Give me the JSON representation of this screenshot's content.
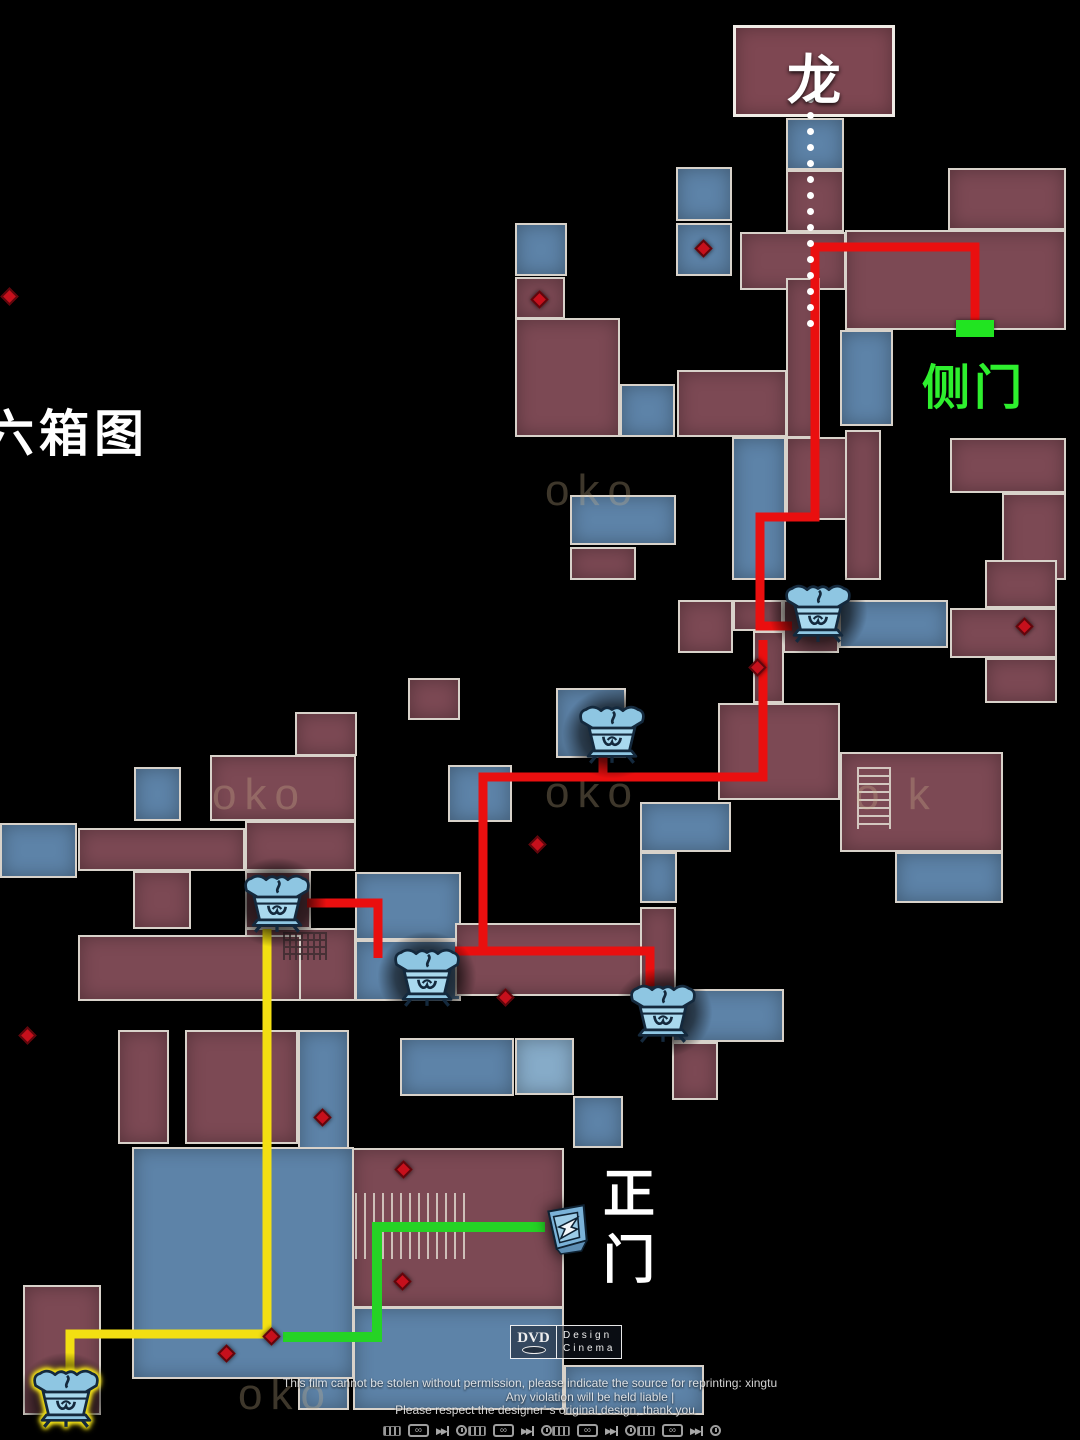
{
  "labels": {
    "dragon": "龙",
    "side_door": "侧门",
    "map_title": "六箱图",
    "main_gate": "正门"
  },
  "watermark": {
    "line1": "This film cannot be stolen without permission, please indicate the source for reprinting: xingtu",
    "line2": "Any violation will be held liable |",
    "line3": "Please respect the designer' s original design, thank you"
  },
  "brand": {
    "name": "DVD",
    "design": "Design",
    "cinema": "Cinema"
  },
  "colors": {
    "background": "#000000",
    "room_red": "#7c4954",
    "room_blue": "#5d83a8",
    "room_blue_light": "#86abc8",
    "wall": "#d8d2ca",
    "path_red": "#ea0f0f",
    "path_yellow": "#f3df12",
    "path_green": "#25d325",
    "door_marker_green": "#21e421",
    "label_green": "#2ef02e",
    "diamond_red": "#c6101c",
    "jar_blue": "#a9d9ee",
    "jar_outline": "#14293d",
    "highlight_yellow": "#f2e117"
  },
  "map": {
    "rooms": [
      [
        733,
        25,
        162,
        92,
        "mb"
      ],
      [
        786,
        118,
        58,
        52,
        "b"
      ],
      [
        786,
        170,
        58,
        62,
        "m"
      ],
      [
        676,
        167,
        56,
        54,
        "b"
      ],
      [
        676,
        223,
        56,
        53,
        "b"
      ],
      [
        740,
        232,
        106,
        58,
        "m"
      ],
      [
        948,
        168,
        118,
        62,
        "m"
      ],
      [
        845,
        230,
        221,
        100,
        "m"
      ],
      [
        515,
        223,
        52,
        53,
        "b"
      ],
      [
        515,
        277,
        50,
        42,
        "m"
      ],
      [
        515,
        318,
        105,
        119,
        "m"
      ],
      [
        620,
        384,
        55,
        53,
        "b"
      ],
      [
        677,
        370,
        110,
        67,
        "m"
      ],
      [
        786,
        278,
        34,
        160,
        "m"
      ],
      [
        732,
        437,
        54,
        143,
        "b"
      ],
      [
        786,
        437,
        64,
        83,
        "m"
      ],
      [
        570,
        495,
        106,
        50,
        "b"
      ],
      [
        570,
        547,
        66,
        33,
        "m"
      ],
      [
        840,
        330,
        53,
        96,
        "b"
      ],
      [
        845,
        430,
        36,
        150,
        "m"
      ],
      [
        950,
        438,
        116,
        55,
        "m"
      ],
      [
        1002,
        493,
        64,
        87,
        "m"
      ],
      [
        985,
        560,
        72,
        48,
        "m"
      ],
      [
        950,
        608,
        107,
        50,
        "m"
      ],
      [
        985,
        658,
        72,
        45,
        "m"
      ],
      [
        678,
        600,
        55,
        53,
        "m"
      ],
      [
        733,
        600,
        50,
        31,
        "m"
      ],
      [
        783,
        600,
        56,
        53,
        "m"
      ],
      [
        839,
        600,
        109,
        48,
        "b"
      ],
      [
        753,
        631,
        31,
        72,
        "m"
      ],
      [
        718,
        703,
        122,
        97,
        "m"
      ],
      [
        840,
        752,
        163,
        100,
        "m"
      ],
      [
        895,
        852,
        108,
        51,
        "b"
      ],
      [
        640,
        802,
        91,
        50,
        "b"
      ],
      [
        556,
        688,
        70,
        70,
        "b"
      ],
      [
        640,
        852,
        37,
        51,
        "b"
      ],
      [
        408,
        678,
        52,
        42,
        "m"
      ],
      [
        448,
        765,
        64,
        57,
        "b"
      ],
      [
        210,
        755,
        146,
        66,
        "m"
      ],
      [
        295,
        712,
        62,
        44,
        "m"
      ],
      [
        78,
        828,
        167,
        43,
        "m"
      ],
      [
        133,
        871,
        58,
        58,
        "m"
      ],
      [
        245,
        821,
        111,
        50,
        "m"
      ],
      [
        245,
        871,
        66,
        58,
        "m"
      ],
      [
        134,
        767,
        47,
        54,
        "b"
      ],
      [
        0,
        823,
        77,
        55,
        "b"
      ],
      [
        355,
        872,
        106,
        68,
        "b"
      ],
      [
        245,
        928,
        111,
        73,
        "m"
      ],
      [
        78,
        935,
        223,
        66,
        "m"
      ],
      [
        355,
        940,
        106,
        61,
        "b"
      ],
      [
        455,
        923,
        196,
        73,
        "m"
      ],
      [
        640,
        907,
        36,
        97,
        "m"
      ],
      [
        672,
        989,
        112,
        53,
        "b"
      ],
      [
        672,
        1042,
        46,
        58,
        "m"
      ],
      [
        118,
        1030,
        51,
        114,
        "m"
      ],
      [
        185,
        1030,
        113,
        114,
        "m"
      ],
      [
        298,
        1030,
        51,
        380,
        "b"
      ],
      [
        132,
        1147,
        222,
        232,
        "b"
      ],
      [
        353,
        1307,
        211,
        103,
        "b"
      ],
      [
        564,
        1365,
        140,
        50,
        "b"
      ],
      [
        23,
        1285,
        78,
        130,
        "m"
      ],
      [
        352,
        1148,
        212,
        160,
        "m"
      ],
      [
        400,
        1038,
        114,
        58,
        "b"
      ],
      [
        515,
        1038,
        59,
        57,
        "lb"
      ],
      [
        573,
        1096,
        50,
        52,
        "b"
      ]
    ],
    "stairs": [
      {
        "x": 857,
        "y": 767,
        "w": 34,
        "h": 62,
        "kind": "ladder"
      },
      {
        "x": 355,
        "y": 1193,
        "w": 112,
        "h": 66,
        "kind": "comb"
      },
      {
        "x": 283,
        "y": 932,
        "w": 44,
        "h": 28,
        "kind": "grid"
      }
    ],
    "ghost_marks": [
      {
        "t": "oko",
        "x": 212,
        "y": 770
      },
      {
        "t": "oko",
        "x": 545,
        "y": 768
      },
      {
        "t": "o k",
        "x": 855,
        "y": 770
      },
      {
        "t": "oko",
        "x": 238,
        "y": 1370
      },
      {
        "t": "oko",
        "x": 545,
        "y": 466
      }
    ],
    "diamonds": [
      [
        540,
        300
      ],
      [
        704,
        249
      ],
      [
        758,
        668
      ],
      [
        1025,
        627
      ],
      [
        538,
        845
      ],
      [
        506,
        998
      ],
      [
        323,
        1118
      ],
      [
        272,
        1337
      ],
      [
        404,
        1170
      ],
      [
        403,
        1282
      ],
      [
        227,
        1354
      ],
      [
        10,
        297
      ],
      [
        28,
        1036
      ]
    ],
    "dotted_path": {
      "x": 810,
      "y0": 96,
      "y1": 330,
      "step": 16
    },
    "routes": [
      {
        "stroke": "path_red",
        "w": 9,
        "pts": [
          [
            975,
            327
          ],
          [
            975,
            247
          ],
          [
            815,
            247
          ],
          [
            815,
            517
          ],
          [
            760,
            517
          ],
          [
            760,
            626
          ],
          [
            792,
            626
          ]
        ]
      },
      {
        "stroke": "path_red",
        "w": 9,
        "pts": [
          [
            763,
            640
          ],
          [
            763,
            777
          ],
          [
            483,
            777
          ],
          [
            483,
            951
          ]
        ]
      },
      {
        "stroke": "path_red",
        "w": 9,
        "pts": [
          [
            455,
            951
          ],
          [
            650,
            951
          ],
          [
            650,
            986
          ]
        ]
      },
      {
        "stroke": "path_red",
        "w": 9,
        "pts": [
          [
            603,
            777
          ],
          [
            603,
            754
          ]
        ]
      },
      {
        "stroke": "path_red",
        "w": 9,
        "pts": [
          [
            307,
            903
          ],
          [
            378,
            903
          ],
          [
            378,
            958
          ]
        ]
      },
      {
        "stroke": "path_yellow",
        "w": 9,
        "pts": [
          [
            267,
            929
          ],
          [
            267,
            1334
          ],
          [
            70,
            1334
          ],
          [
            70,
            1374
          ]
        ]
      },
      {
        "stroke": "path_green",
        "w": 10,
        "pts": [
          [
            283,
            1337
          ],
          [
            377,
            1337
          ],
          [
            377,
            1227
          ],
          [
            545,
            1227
          ]
        ]
      }
    ],
    "jars": [
      {
        "x": 818,
        "y": 612,
        "hl": false
      },
      {
        "x": 612,
        "y": 733,
        "hl": false
      },
      {
        "x": 277,
        "y": 902,
        "hl": false
      },
      {
        "x": 427,
        "y": 976,
        "hl": false
      },
      {
        "x": 663,
        "y": 1012,
        "hl": false
      },
      {
        "x": 66,
        "y": 1397,
        "hl": true
      }
    ],
    "door_icon": {
      "x": 565,
      "y": 1226
    },
    "side_door_marker": {
      "x": 956,
      "y": 320,
      "w": 38,
      "h": 17
    }
  },
  "controls": {
    "group_x": [
      383,
      468,
      552,
      637
    ],
    "icons": [
      "hifi-badge",
      "loop",
      "next-track",
      "clock"
    ],
    "loop_glyph": "∞",
    "next_glyph": "▶▶"
  }
}
